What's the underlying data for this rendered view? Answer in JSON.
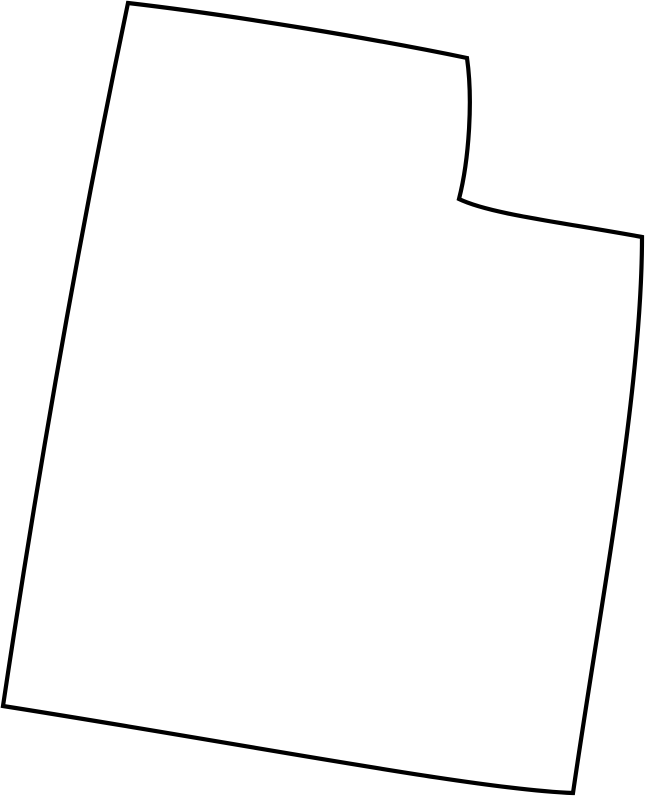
{
  "page": {
    "background_color": "#ffffff",
    "width": 649,
    "height": 800
  },
  "map": {
    "shape_name": "utah-state-outline",
    "viewbox": "0 0 649 800",
    "outline": {
      "d": "M 128 3 C 240 16 380 40 467 58 C 473 100 469 160 459 199 C 490 214 560 222 642 237 C 642 390 601 600 573 793 C 480 790 250 745 3 706 C 38 472 79 237 128 3 Z",
      "stroke_color": "#000000",
      "stroke_width": 4.2,
      "fill_color": "#ffffff",
      "linejoin": "miter",
      "linecap": "butt",
      "vertices": {
        "top_left": [
          128,
          3
        ],
        "notch_top": [
          467,
          58
        ],
        "notch_inner": [
          459,
          199
        ],
        "top_right": [
          642,
          237
        ],
        "bottom_right": [
          573,
          793
        ],
        "bottom_left": [
          3,
          706
        ]
      }
    }
  }
}
